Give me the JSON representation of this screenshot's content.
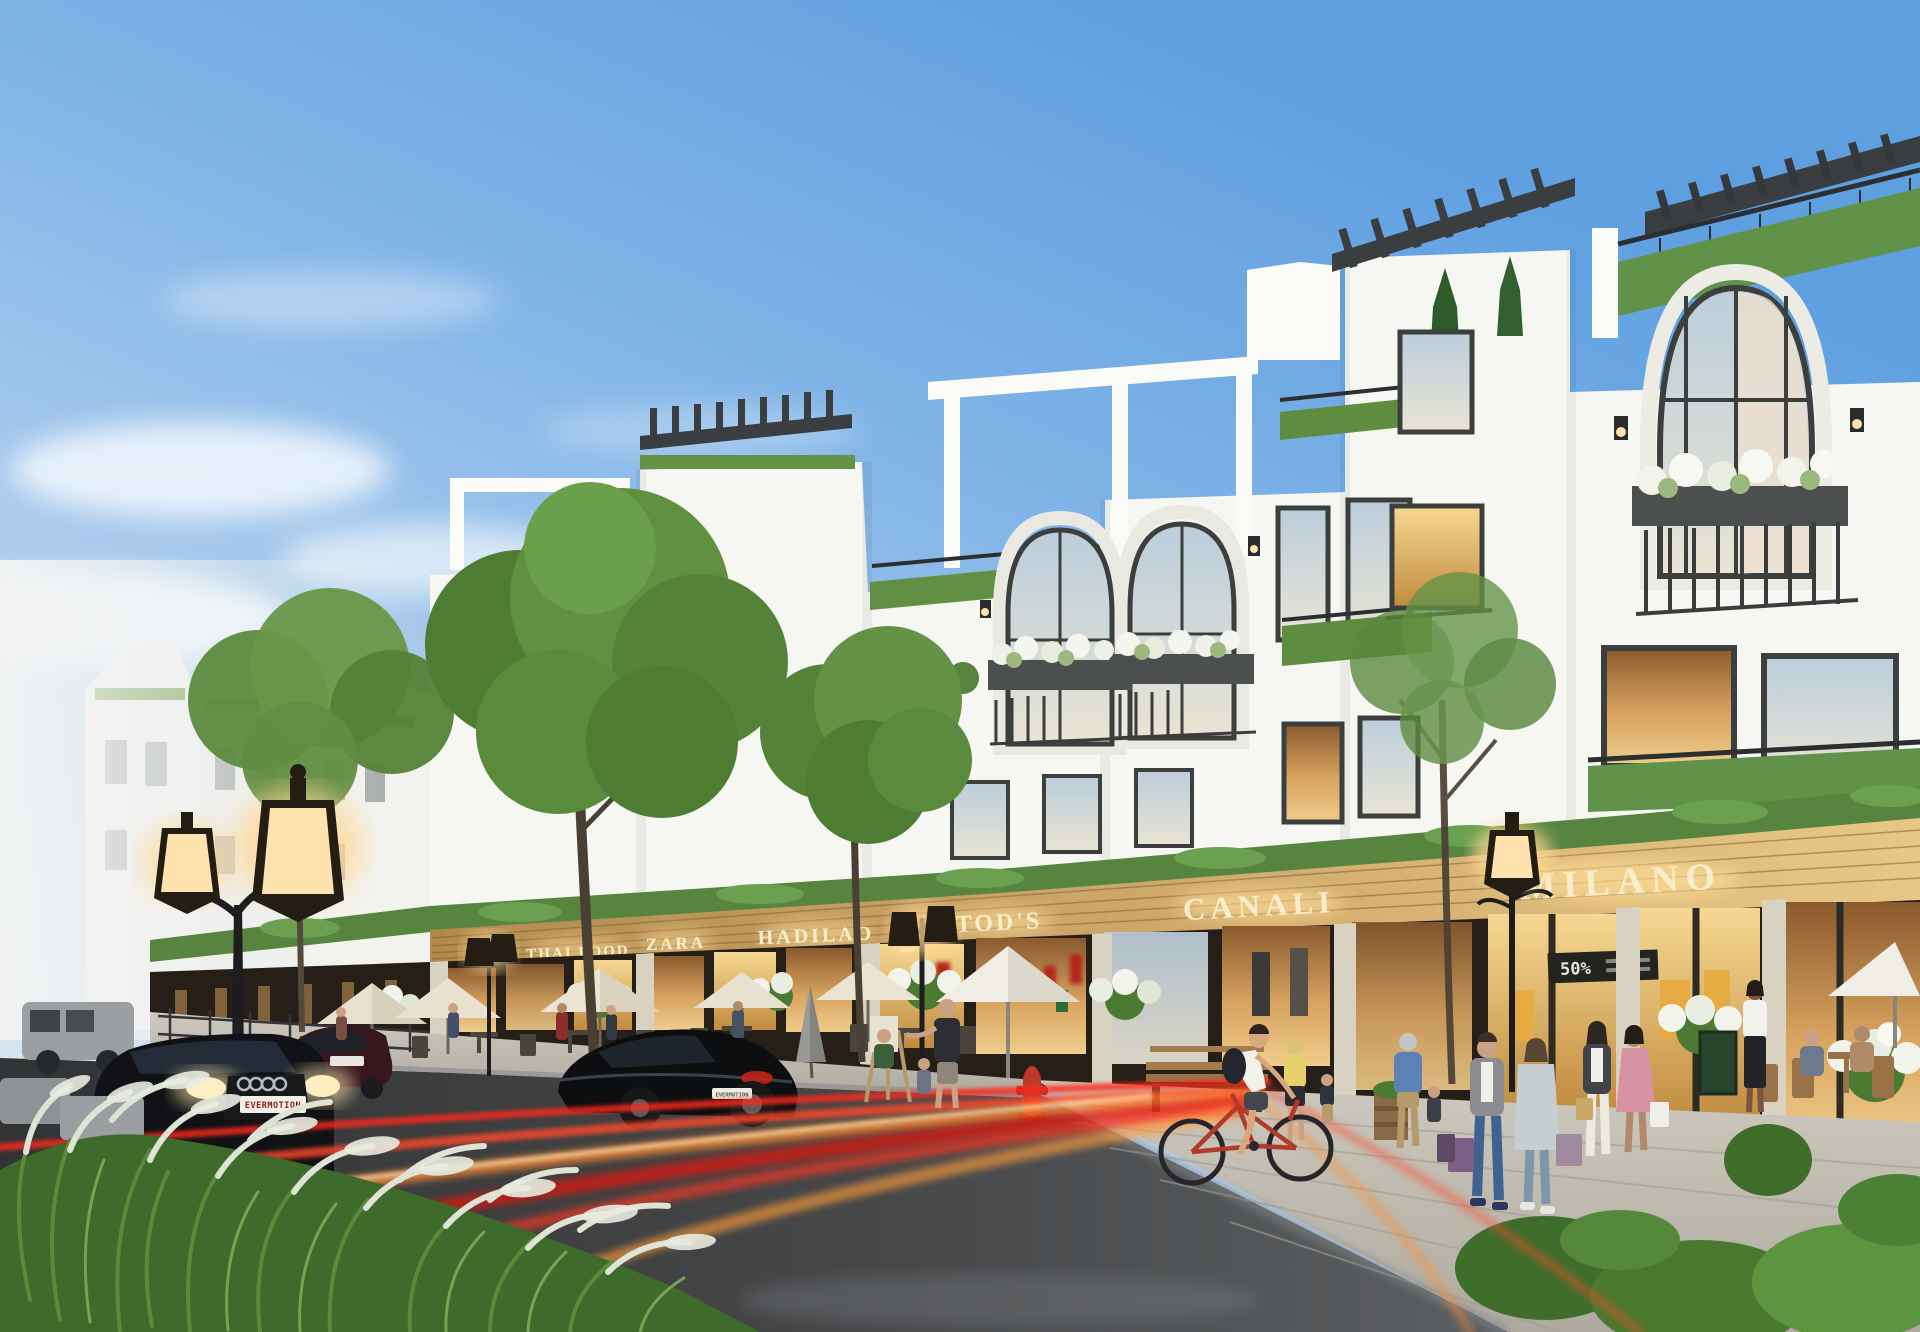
{
  "signs": {
    "thai_food": "THAI FOOD",
    "zara": "ZARA",
    "hadilao": "HADILAO",
    "tods": "TOD'S",
    "canali": "CANALI",
    "milano": "MILANO"
  },
  "vehicle": {
    "license_plate": "EVERMOTION"
  },
  "storefront": {
    "sale_tag": "50%"
  },
  "palette": {
    "sky_top": "#5e9fe0",
    "sky_horizon": "#eef1f2",
    "facade_white": "#f6f6f2",
    "facade_shadow": "#e4e7e3",
    "fascia_wood": "#c9a368",
    "fascia_wood_lit": "#e6c584",
    "sign_letters": "#f9eecb",
    "hedge_green": "#5c8f3b",
    "tree_green": "#56873a",
    "storefront_glow": "#e9b867",
    "storefront_frame": "#2e2a24",
    "asphalt": "#46484a",
    "sidewalk": "#c3bfb4",
    "light_trail_red": "#ff2b1b",
    "light_trail_orange": "#ff8c33",
    "lamp_black": "#1d1d20",
    "lamp_glow": "#ffd894",
    "hydrant_red": "#c0392b",
    "umbrella_cream": "#e9e1cf",
    "bicycle_red": "#b23a2b",
    "grass_plume": "#dde4d6"
  }
}
